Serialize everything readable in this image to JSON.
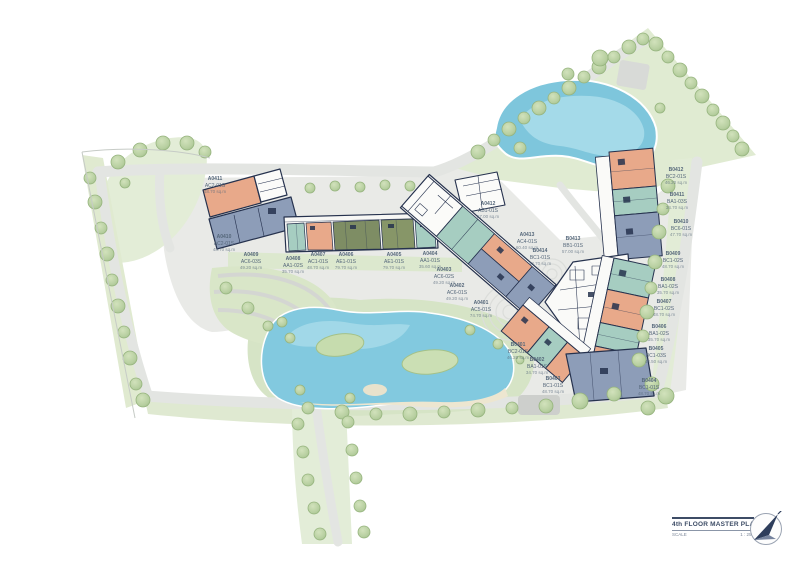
{
  "plan": {
    "title": "4th FLOOR MASTER PLAN",
    "scale_label": "SCALE",
    "scale_value": "1 : 250",
    "compass_icon": "north-arrow"
  },
  "units": [
    {
      "id": "A0411",
      "type": "AC2-01S",
      "area": "48.70 sq.m"
    },
    {
      "id": "A0410",
      "type": "AC2-01S",
      "area": "48.70 sq.m"
    },
    {
      "id": "A0409",
      "type": "AC6-03S",
      "area": "49.20 sq.m"
    },
    {
      "id": "A0408",
      "type": "AA1-02S",
      "area": "35.70 sq.m"
    },
    {
      "id": "A0407",
      "type": "AC1-01S",
      "area": "48.70 sq.m"
    },
    {
      "id": "A0406",
      "type": "AE1-01S",
      "area": "79.70 sq.m"
    },
    {
      "id": "A0405",
      "type": "AE1-01S",
      "area": "79.70 sq.m"
    },
    {
      "id": "A0404",
      "type": "AA1-01S",
      "area": "35.60 sq.m"
    },
    {
      "id": "A0403",
      "type": "AC6-02S",
      "area": "49.20 sq.m"
    },
    {
      "id": "A0402",
      "type": "AC6-01S",
      "area": "49.20 sq.m"
    },
    {
      "id": "A0401",
      "type": "AC5-01S",
      "area": "74.70 sq.m"
    },
    {
      "id": "A0412",
      "type": "AB1-01S",
      "area": "57.00 sq.m"
    },
    {
      "id": "A0413",
      "type": "AC4-01S",
      "area": "60.40 sq.m"
    },
    {
      "id": "B0414",
      "type": "BC1-01S",
      "area": "48.70 sq.m"
    },
    {
      "id": "B0413",
      "type": "BB1-01S",
      "area": "57.00 sq.m"
    },
    {
      "id": "B0412",
      "type": "BC2-01S",
      "area": "46.20 sq.m"
    },
    {
      "id": "B0411",
      "type": "BA1-03S",
      "area": "34.70 sq.m"
    },
    {
      "id": "B0410",
      "type": "BC6-01S",
      "area": "47.70 sq.m"
    },
    {
      "id": "B0409",
      "type": "BC1-02S",
      "area": "48.70 sq.m"
    },
    {
      "id": "B0408",
      "type": "BA1-02S",
      "area": "35.70 sq.m"
    },
    {
      "id": "B0407",
      "type": "BC1-02S",
      "area": "48.70 sq.m"
    },
    {
      "id": "B0406",
      "type": "BA1-02S",
      "area": "35.70 sq.m"
    },
    {
      "id": "B0405",
      "type": "BC1-03S",
      "area": "48.50 sq.m"
    },
    {
      "id": "B0404",
      "type": "BC1-01S",
      "area": "48.70 sq.m"
    },
    {
      "id": "B0403",
      "type": "BC1-01S",
      "area": "48.70 sq.m"
    },
    {
      "id": "B0402",
      "type": "BA1-01S",
      "area": "34.70 sq.m"
    },
    {
      "id": "B0401",
      "type": "BC2-01S",
      "area": "46.20 sq.m"
    }
  ],
  "colors": {
    "salmon_unit": "#E8A98A",
    "blue_gray_unit": "#8D9DB8",
    "teal_unit": "#A6CDC1",
    "olive_unit": "#7E8D64",
    "water": "#7EC6DC",
    "green": "#DFEAD1",
    "road": "#E3E5E2",
    "wall": "#26324E",
    "label_text": "#55677A",
    "title_text": "#3D4C66"
  }
}
